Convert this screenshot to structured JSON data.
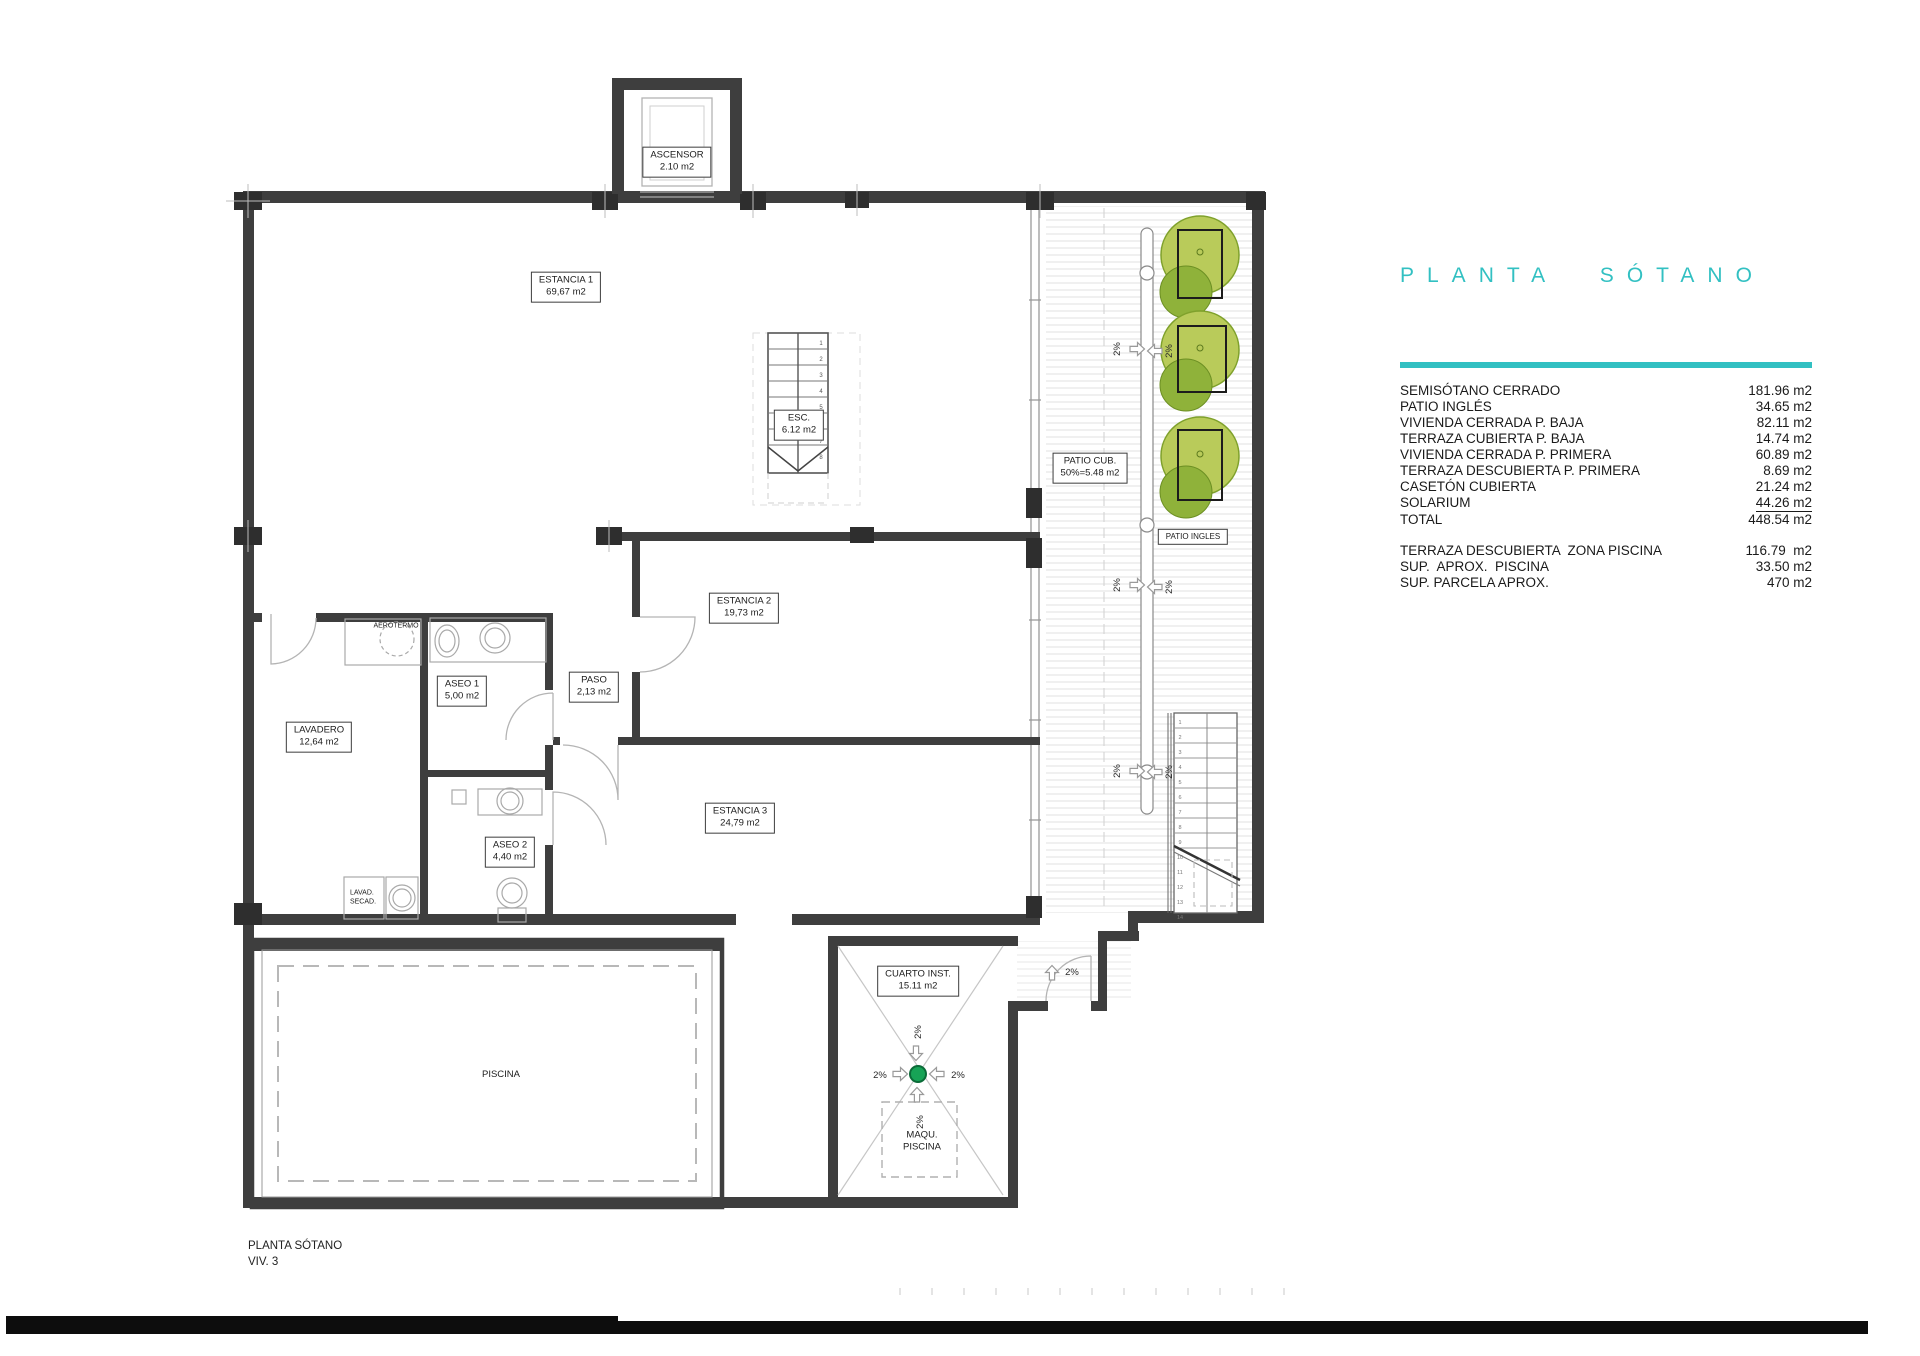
{
  "title": "PLANTA SÓTANO",
  "colors": {
    "accent": "#32c0c2",
    "tree_green": "#b9cb5a",
    "tree_dark": "#8fb23a",
    "drain_green": "#17a356",
    "wall": "#3e3e3e"
  },
  "legend": {
    "rows": [
      {
        "label": "SEMISÓTANO CERRADO",
        "value": "181.96 m2"
      },
      {
        "label": "PATIO INGLÉS",
        "value": "34.65 m2"
      },
      {
        "label": "VIVIENDA CERRADA P. BAJA",
        "value": "82.11 m2"
      },
      {
        "label": "TERRAZA CUBIERTA P. BAJA",
        "value": "14.74 m2"
      },
      {
        "label": "VIVIENDA CERRADA P. PRIMERA",
        "value": "60.89 m2"
      },
      {
        "label": "TERRAZA DESCUBIERTA P. PRIMERA",
        "value": "8.69 m2"
      },
      {
        "label": "CASETÓN CUBIERTA",
        "value": "21.24 m2"
      },
      {
        "label": "SOLARIUM",
        "value": "44.26 m2"
      },
      {
        "label": "TOTAL",
        "value": "448.54 m2"
      }
    ],
    "summary": [
      {
        "label": "TERRAZA DESCUBIERTA  ZONA PISCINA",
        "value": "116.79  m2"
      },
      {
        "label": "SUP.  APROX.  PISCINA",
        "value": "33.50 m2"
      },
      {
        "label": "SUP. PARCELA APROX.",
        "value": "470 m2"
      }
    ]
  },
  "rooms": {
    "ascensor": {
      "name": "ASCENSOR",
      "area": "2.10 m2"
    },
    "estancia1": {
      "name": "ESTANCIA 1",
      "area": "69,67 m2"
    },
    "esc": {
      "name": "ESC.",
      "area": "6.12 m2"
    },
    "patio_cub": {
      "name": "PATIO CUB.",
      "area": "50%=5.48 m2"
    },
    "patio_ingles": {
      "name": "PATIO INGLES"
    },
    "estancia2": {
      "name": "ESTANCIA 2",
      "area": "19,73 m2"
    },
    "aseo1": {
      "name": "ASEO 1",
      "area": "5,00 m2"
    },
    "paso": {
      "name": "PASO",
      "area": "2,13 m2"
    },
    "aerotermo": {
      "name": "AEROTERMO"
    },
    "lavadero": {
      "name": "LAVADERO",
      "area": "12,64 m2"
    },
    "aseo2": {
      "name": "ASEO 2",
      "area": "4,40 m2"
    },
    "estancia3": {
      "name": "ESTANCIA 3",
      "area": "24,79 m2"
    },
    "lavad_secad": {
      "line1": "LAVAD.",
      "line2": "SECAD."
    },
    "cuarto_inst": {
      "name": "CUARTO INST.",
      "area": "15.11 m2"
    },
    "maqu_piscina": {
      "line1": "MAQU.",
      "line2": "PISCINA"
    },
    "piscina": {
      "name": "PISCINA"
    }
  },
  "slope": {
    "label": "2%"
  },
  "stairs": {
    "esc": [
      "1",
      "2",
      "3",
      "4",
      "5",
      "6",
      "7",
      "8"
    ],
    "patio": [
      "1",
      "2",
      "3",
      "4",
      "5",
      "6",
      "7",
      "8",
      "9",
      "10",
      "11",
      "12",
      "13",
      "14"
    ]
  },
  "footer": {
    "line1": "PLANTA SÓTANO",
    "line2": "VIV. 3"
  }
}
